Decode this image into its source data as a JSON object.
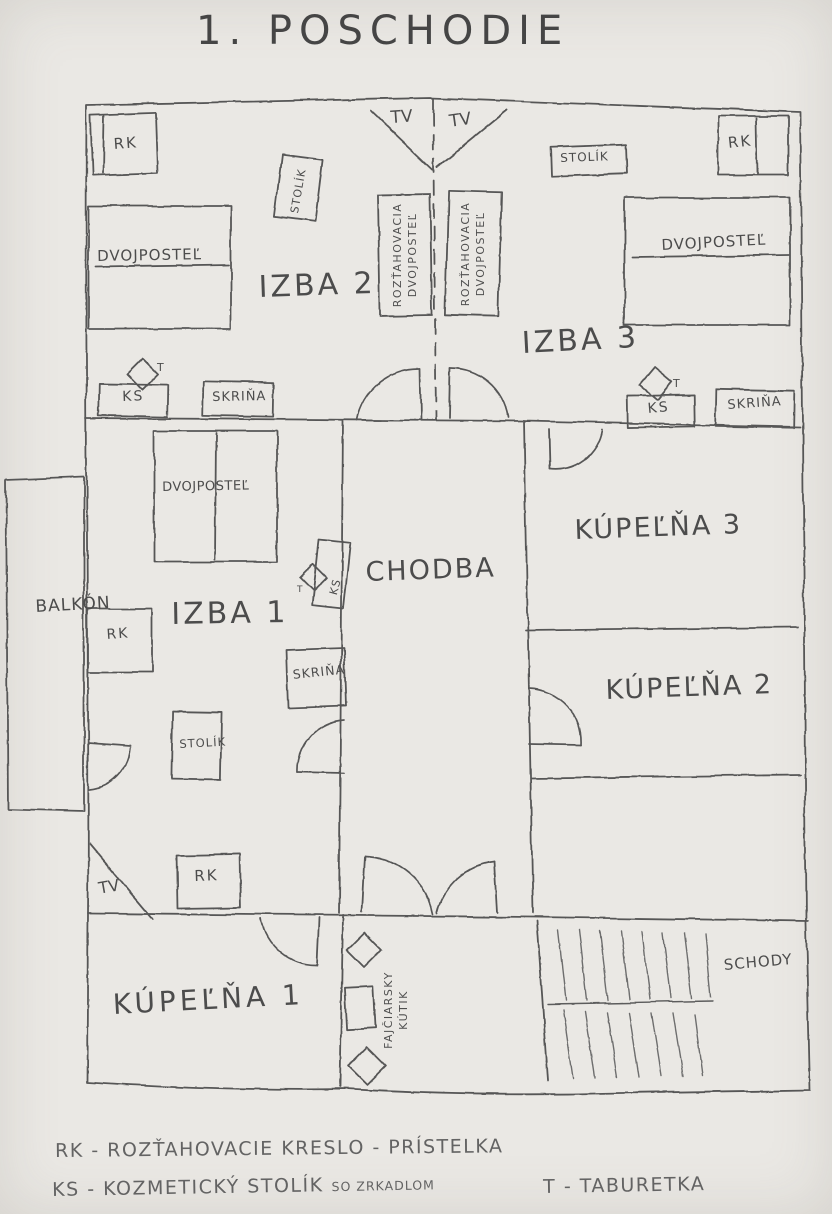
{
  "title": "1. POSCHODIE",
  "rooms": {
    "izba1": "IZBA 1",
    "izba2": "IZBA 2",
    "izba3": "IZBA 3",
    "chodba": "CHODBA",
    "kupelna1": "KÚPEĽŇA 1",
    "kupelna2": "KÚPEĽŇA 2",
    "kupelna3": "KÚPEĽŇA 3",
    "balkon": "BALKÓN",
    "schody": "SCHODY",
    "fajciarsky_line1": "FAJČIARSKY",
    "fajciarsky_line2": "KÚTIK"
  },
  "furniture": {
    "rk": "RK",
    "ks": "KS",
    "t": "T",
    "tv": "TV",
    "stolik": "STOLÍK",
    "skrina": "SKRIŇA",
    "dvojpostel": "DVOJPOSTEĽ",
    "roztahovacia": "ROZŤAHOVACIA"
  },
  "legend": {
    "rk": "RK - ROZŤAHOVACIE KRESLO - PRÍSTELKA",
    "ks": "KS - KOZMETICKÝ STOLÍK",
    "ks_note": "SO ZRKADLOM",
    "t": "T - TABURETKA"
  }
}
